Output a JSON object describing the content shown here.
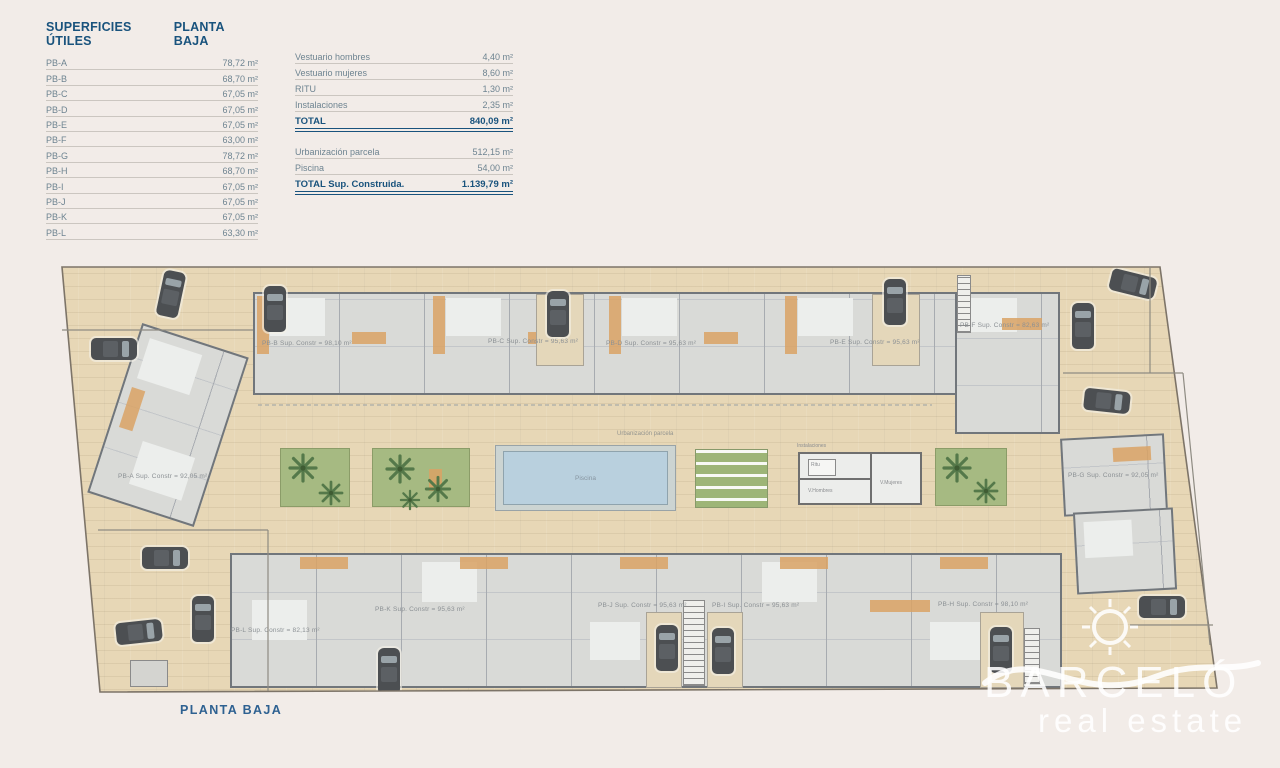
{
  "left_table": {
    "header_left": "SUPERFICIES ÚTILES",
    "header_right": "PLANTA BAJA",
    "rows": [
      {
        "label": "PB-A",
        "value": "78,72 m²"
      },
      {
        "label": "PB-B",
        "value": "68,70 m²"
      },
      {
        "label": "PB-C",
        "value": "67,05 m²"
      },
      {
        "label": "PB-D",
        "value": "67,05 m²"
      },
      {
        "label": "PB-E",
        "value": "67,05 m²"
      },
      {
        "label": "PB-F",
        "value": "63,00 m²"
      },
      {
        "label": "PB-G",
        "value": "78,72 m²"
      },
      {
        "label": "PB-H",
        "value": "68,70 m²"
      },
      {
        "label": "PB-I",
        "value": "67,05 m²"
      },
      {
        "label": "PB-J",
        "value": "67,05 m²"
      },
      {
        "label": "PB-K",
        "value": "67,05 m²"
      },
      {
        "label": "PB-L",
        "value": "63,30 m²"
      }
    ]
  },
  "summary_table": {
    "rows_a": [
      {
        "label": "Vestuario hombres",
        "value": "4,40 m²"
      },
      {
        "label": "Vestuario mujeres",
        "value": "8,60 m²"
      },
      {
        "label": "RITU",
        "value": "1,30 m²"
      },
      {
        "label": "Instalaciones",
        "value": "2,35 m²"
      }
    ],
    "total_a": {
      "label": "TOTAL",
      "value": "840,09 m²"
    },
    "rows_b": [
      {
        "label": "Urbanización parcela",
        "value": "512,15 m²"
      },
      {
        "label": "Piscina",
        "value": "54,00 m²"
      }
    ],
    "total_b": {
      "label": "TOTAL Sup. Construida.",
      "value": "1.139,79 m²"
    }
  },
  "plan": {
    "units": {
      "pb_a": "PB-A Sup. Constr = 92,05 m²",
      "pb_b": "PB-B Sup. Constr = 98,10 m²",
      "pb_c": "PB-C Sup. Constr = 95,63 m²",
      "pb_d": "PB-D Sup. Constr = 95,63 m²",
      "pb_e": "PB-E Sup. Constr = 95,63 m²",
      "pb_f": "PB-F Sup. Constr = 82,63 m²",
      "pb_g": "PB-G Sup. Constr = 92,05 m²",
      "pb_h": "PB-H Sup. Constr = 98,10 m²",
      "pb_i": "PB-I Sup. Constr = 95,63 m²",
      "pb_j": "PB-J Sup. Constr = 95,63 m²",
      "pb_k": "PB-K Sup. Constr = 95,63 m²",
      "pb_l": "PB-L Sup. Constr = 82,13 m²"
    },
    "labels": {
      "urbanizacion": "Urbanización parcela",
      "piscina": "Piscina",
      "instalaciones": "Instalaciones",
      "ritu": "Ritu",
      "v_hombres": "V.Hombres",
      "v_mujeres": "V.Mujeres"
    }
  },
  "footer": {
    "caption": "PLANTA BAJA"
  },
  "watermark": {
    "brand": "Barceló",
    "tagline": "real estate"
  },
  "colors": {
    "accent_blue": "#19537d",
    "paving": "#e7d7b6",
    "pool_water": "#b9d0de",
    "garden_green": "#a6ba82",
    "building_floor": "#d9dad7",
    "wall_gray": "#71767b",
    "accent_orange": "#d9a265"
  }
}
